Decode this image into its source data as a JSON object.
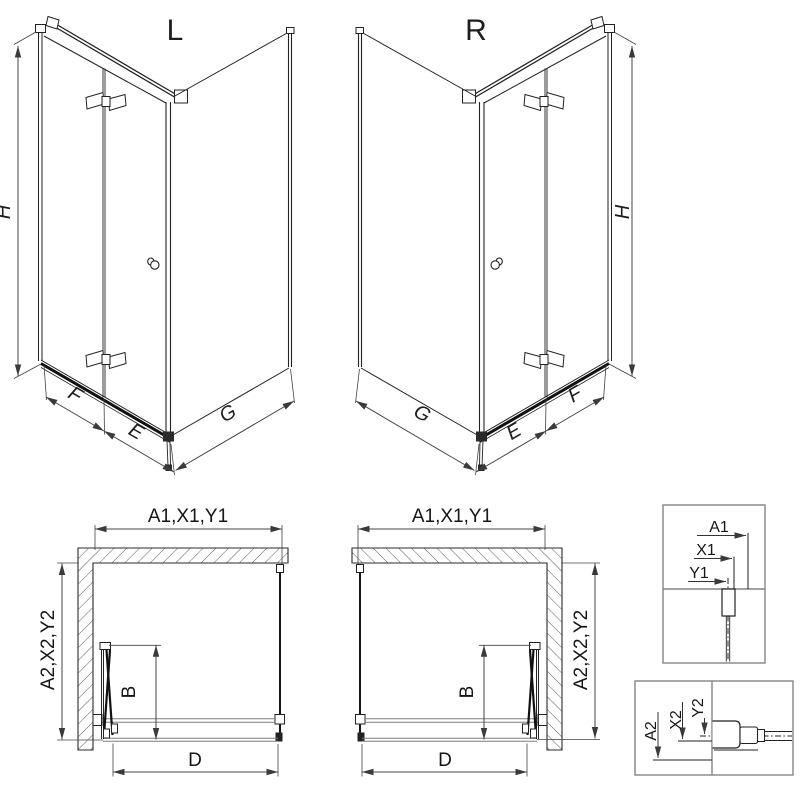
{
  "iso": {
    "left_title": "L",
    "right_title": "R",
    "height": "H",
    "front_fold": "F",
    "front_edge": "E",
    "side_panel": "G"
  },
  "plan": {
    "width_dim": "A1,X1,Y1",
    "depth_dim": "A2,X2,Y2",
    "door_panel_dim": "B",
    "entry_dim": "D"
  },
  "detail_top": {
    "a1": "A1",
    "x1": "X1",
    "y1": "Y1"
  },
  "detail_bottom": {
    "a2": "A2",
    "x2": "X2",
    "y2": "Y2"
  },
  "colors": {
    "line": "#222222",
    "dim": "#444444",
    "profile_gray": "#7d7d7d",
    "box_border": "#848484",
    "background": "#ffffff"
  }
}
